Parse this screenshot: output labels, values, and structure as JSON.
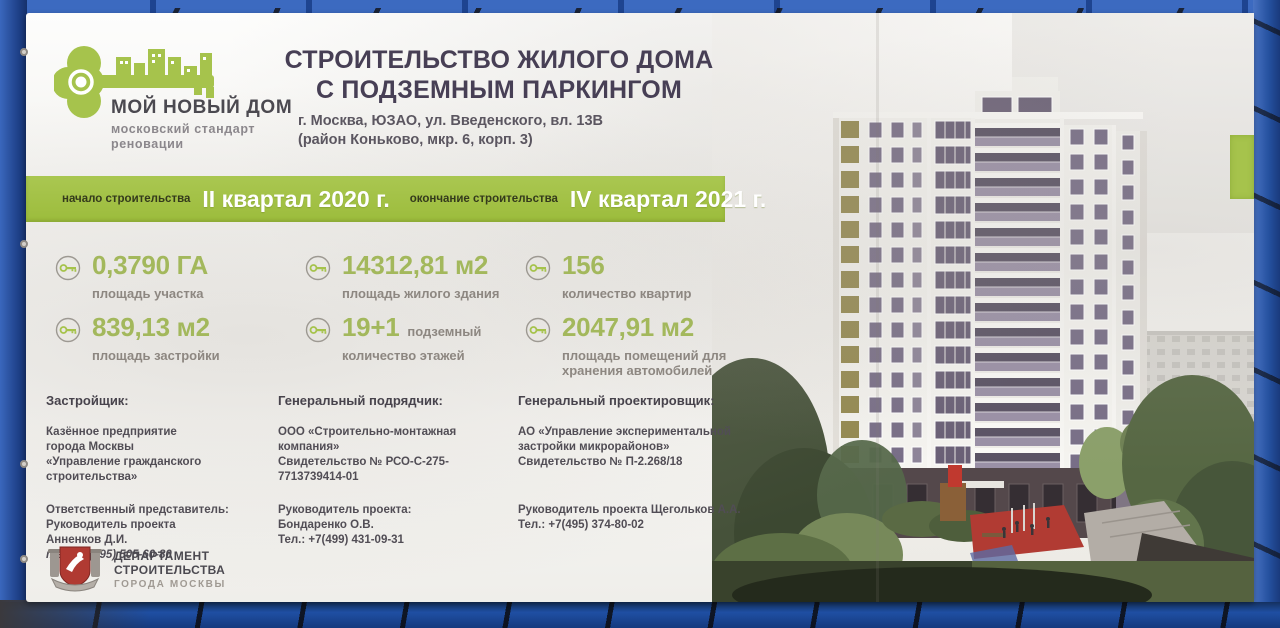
{
  "logo": {
    "title": "МОЙ НОВЫЙ ДОМ",
    "subtitle_lines": [
      "московский стандарт",
      "реновации"
    ]
  },
  "title": {
    "line1": "СТРОИТЕЛЬСТВО ЖИЛОГО ДОМА",
    "line2": "С ПОДЗЕМНЫМ ПАРКИНГОМ",
    "address_lines": [
      "г. Москва, ЮЗАО, ул. Введенского, вл. 13В",
      "(район Коньково, мкр. 6, корп. 3)"
    ]
  },
  "timeline": {
    "start_label": "начало строительства",
    "start_value": "II квартал 2020 г.",
    "end_label": "окончание строительства",
    "end_value": "IV квартал 2021 г."
  },
  "stats": [
    {
      "value": "0,3790 ГА",
      "label": "площадь участка"
    },
    {
      "value": "14312,81 м2",
      "label": "площадь жилого здания"
    },
    {
      "value": "156",
      "label": "количество квартир"
    },
    {
      "value": "839,13 м2",
      "label": "площадь застройки"
    },
    {
      "value": "19+1",
      "suffix": "подземный",
      "label": "количество этажей"
    },
    {
      "value": "2047,91 м2",
      "label": "площадь помещений для хранения автомобилей"
    }
  ],
  "contractors": [
    {
      "heading": "Застройщик:",
      "org_lines": [
        "Казённое предприятие",
        "города Москвы",
        "«Управление гражданского",
        "строительства»"
      ],
      "rep_lines": [
        "Ответственный представитель:",
        "Руководитель проекта",
        "Анненков Д.И."
      ],
      "tel": "тел. +7(495) 505-60-80"
    },
    {
      "heading": "Генеральный подрядчик:",
      "org_lines": [
        "ООО «Строительно-монтажная компания»",
        "Свидетельство № РСО-С-275-7713739414-01"
      ],
      "rep_lines": [
        "Руководитель проекта:",
        "Бондаренко О.В.",
        "Тел.: +7(499) 431-09-31"
      ]
    },
    {
      "heading": "Генеральный проектировщик:",
      "org_lines": [
        "АО «Управление экспериментальной",
        "застройки микрорайонов»",
        "Свидетельство № П-2.268/18"
      ],
      "rep_lines": [
        "Руководитель проекта Щегольков А.А.",
        "Тел.: +7(495) 374-80-02"
      ]
    }
  ],
  "department": {
    "line1": "ДЕПАРТАМЕНТ",
    "line2": "СТРОИТЕЛЬСТВА",
    "line3": "ГОРОДА МОСКВЫ"
  },
  "colors": {
    "brand_green": "#a6c34c",
    "value_green": "#a3b85c",
    "title_dark": "#473f55",
    "label_gray": "#8d8781",
    "frame_blue": "#2b55a3",
    "department_red": "#b03a32",
    "playground_red": "#b13b33"
  }
}
